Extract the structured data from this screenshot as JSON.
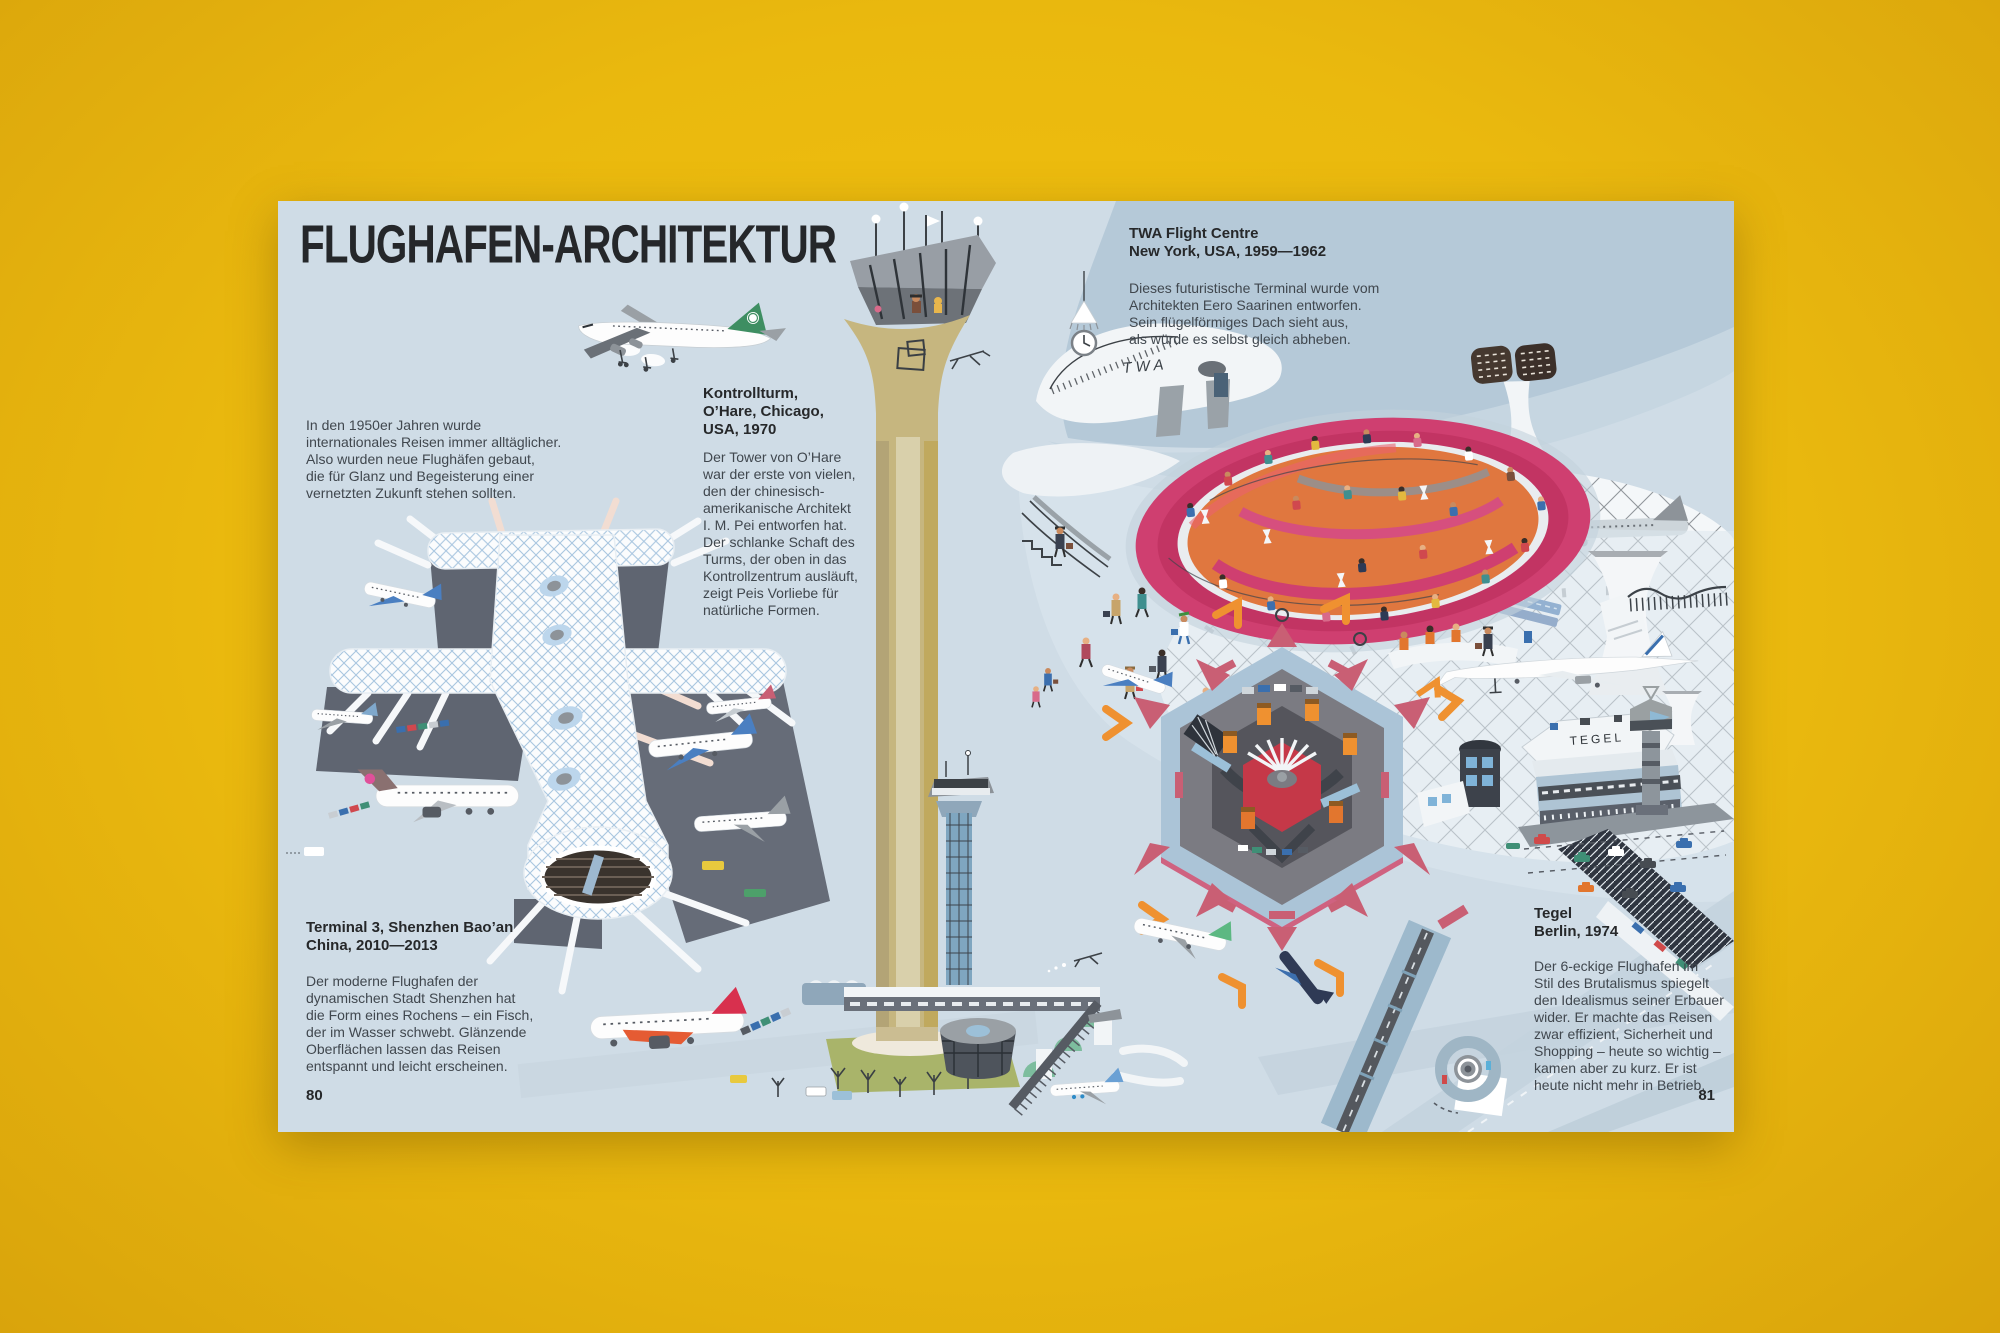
{
  "page": {
    "title": "FLUGHAFEN-ARCHITEKTUR",
    "intro": "In den 1950er Jahren wurde\ninternationales Reisen immer alltäglicher.\nAlso wurden neue Flughäfen gebaut,\ndie für Glanz und Begeisterung einer\nvernetzten Zukunft stehen sollten.",
    "page_number_left": "80",
    "page_number_right": "81"
  },
  "sections": {
    "ohare": {
      "heading": "Kontrollturm,\nO’Hare, Chicago,\nUSA, 1970",
      "body": "Der Tower von O’Hare\nwar der erste von vielen,\nden der chinesisch-\namerikanische Architekt\nI. M. Pei entworfen hat.\nDer schlanke Schaft des\nTurms, der oben in das\nKontrollzentrum ausläuft,\nzeigt Peis Vorliebe für\nnatürliche Formen."
    },
    "twa": {
      "heading": "TWA Flight Centre\nNew York, USA, 1959—1962",
      "body": "Dieses futuristische Terminal wurde vom\nArchitekten Eero Saarinen entworfen.\nSein flügelförmiges Dach sieht aus,\nals würde es selbst gleich abheben."
    },
    "shenzhen": {
      "heading": "Terminal 3, Shenzhen Bao’an\nChina, 2010—2013",
      "body": "Der moderne Flughafen der\ndynamischen Stadt Shenzhen hat\ndie Form eines Rochens – ein Fisch,\nder im Wasser schwebt. Glänzende\nOberflächen lassen das Reisen\nentspannt und leicht erscheinen."
    },
    "tegel": {
      "heading": "Tegel\nBerlin, 1974",
      "body": "Der 6-eckige Flughafen im\nStil des Brutalismus spiegelt\nden Idealismus seiner Erbauer\nwider. Er machte das Reisen\nzwar effizient, Sicherheit und\nShopping – heute so wichtig –\nkamen aber zu kurz. Er ist\nheute nicht mehr in Betrieb."
    }
  },
  "illustration": {
    "twa_sign": "TWA",
    "tegel_sign": "TEGEL"
  },
  "colors": {
    "background_yellow": "#eebc10",
    "page_blue": "#cfdce6",
    "twa_band_blue": "#b5c9d8",
    "lounge_pink": "#cf3f70",
    "lounge_orange": "#e0773f",
    "tegel_red": "#c53848",
    "crane_orange": "#ef9130",
    "tower_tan": "#c6b67f",
    "apron_gray": "#5f6571",
    "ink": "#26282a"
  }
}
